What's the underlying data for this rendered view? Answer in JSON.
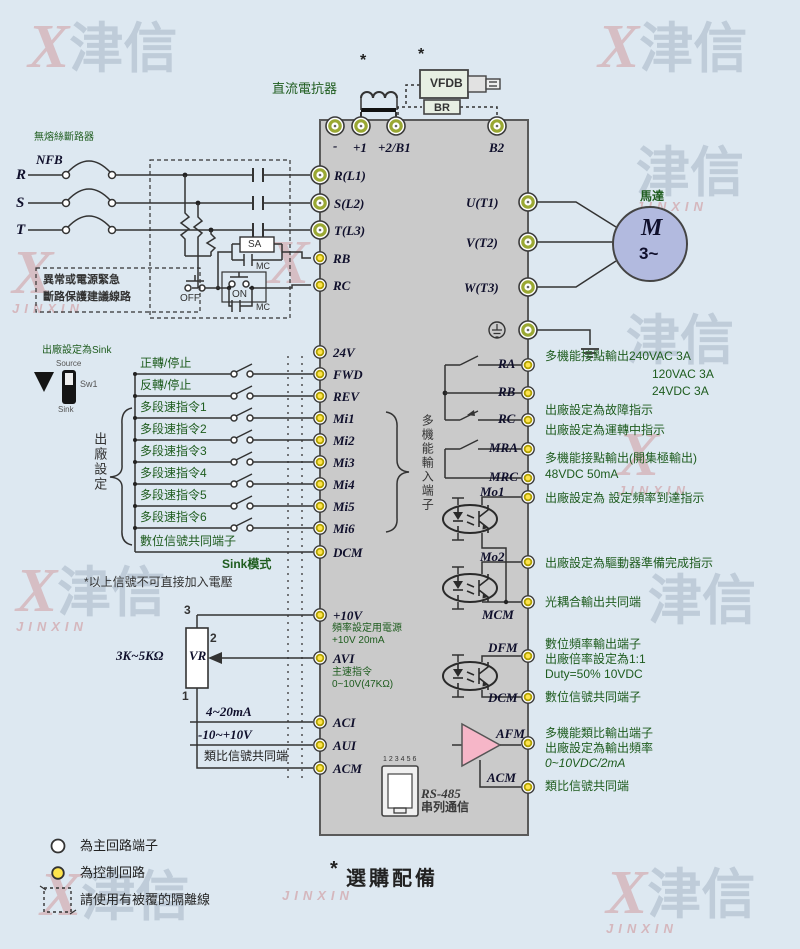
{
  "watermark": {
    "x": "X",
    "cn": "津信",
    "en": "JINXIN"
  },
  "colors": {
    "background": "#dde8f1",
    "block": "#cacaca",
    "annotation_green": "#1e5c1e",
    "terminal_navy": "#10102c",
    "main_terminal_ring": "#9aa833",
    "control_terminal_fill": "#ffe44d",
    "motor_fill": "#b2badf",
    "afm_triangle": "#f6b6c8",
    "vfdb_fill": "#e7efe3"
  },
  "top": {
    "optional_star1": "*",
    "optional_star2": "*",
    "dc_reactor_label": "直流電抗器",
    "vfdb_label": "VFDB",
    "br_label": "BR",
    "terminal_minus": "-",
    "terminal_p1": "+1",
    "terminal_p2b1": "+2/B1",
    "terminal_b2": "B2"
  },
  "power_input": {
    "breaker_note": "無熔絲斷路器",
    "nfb_label": "NFB",
    "phase_r": "R",
    "phase_s": "S",
    "phase_t": "T",
    "r_l1": "R(L1)",
    "s_l2": "S(L2)",
    "t_l3": "T(L3)",
    "protect_note_line1": "異常或電源緊急",
    "protect_note_line2": "斷路保護建議線路",
    "sa_label": "SA",
    "mc_label1": "MC",
    "off_label": "OFF",
    "on_label": "ON",
    "mc_label2": "MC",
    "rb": "RB",
    "rc": "RC"
  },
  "digital_inputs": {
    "sink_default_note": "出廠設定為Sink",
    "source_label": "Source",
    "sw1_label": "Sw1",
    "sink_label": "Sink",
    "factory_brace_label": "出廠設定",
    "terminal_24v": "24V",
    "rows": [
      {
        "label": "正轉/停止",
        "terminal": "FWD"
      },
      {
        "label": "反轉/停止",
        "terminal": "REV"
      },
      {
        "label": "多段速指令1",
        "terminal": "Mi1"
      },
      {
        "label": "多段速指令2",
        "terminal": "Mi2"
      },
      {
        "label": "多段速指令3",
        "terminal": "Mi3"
      },
      {
        "label": "多段速指令4",
        "terminal": "Mi4"
      },
      {
        "label": "多段速指令5",
        "terminal": "Mi5"
      },
      {
        "label": "多段速指令6",
        "terminal": "Mi6"
      },
      {
        "label": "數位信號共同端子",
        "terminal": "DCM"
      }
    ],
    "multi_input_brace_label": "多機能輸入端子",
    "sink_mode": "Sink模式",
    "voltage_warning": "*以上信號不可直接加入電壓"
  },
  "analog_inputs": {
    "vr_value": "3K~5KΩ",
    "vr_label": "VR",
    "pin3": "3",
    "pin2": "2",
    "pin1": "1",
    "p10v": "+10V",
    "p10v_note1": "頻率設定用電源",
    "p10v_note2": "+10V 20mA",
    "avi": "AVI",
    "avi_note1": "主速指令",
    "avi_note2": "0~10V(47KΩ)",
    "aci": "ACI",
    "aci_signal": "4~20mA",
    "aui": "AUI",
    "aui_signal": "-10~+10V",
    "acm": "ACM",
    "acm_signal": "類比信號共同端"
  },
  "motor_output": {
    "u_t1": "U(T1)",
    "v_t2": "V(T2)",
    "w_t3": "W(T3)",
    "motor_label": "馬達",
    "motor_m": "M",
    "motor_phase": "3~"
  },
  "relay_outputs": {
    "ra": "RA",
    "rb": "RB",
    "rc": "RC",
    "mra": "MRA",
    "mrc": "MRC",
    "note1": "多機能接點輸出240VAC 3A",
    "note2": "120VAC 3A",
    "note3": "24VDC 3A",
    "note4": "出廠設定為故障指示",
    "note5": "出廠設定為運轉中指示",
    "note6": "多機能接點輸出(開集極輸出)",
    "note7": "48VDC 50mA"
  },
  "opto_outputs": {
    "mo1": "Mo1",
    "mo1_note": "出廠設定為 設定頻率到達指示",
    "mo2": "Mo2",
    "mo2_note": "出廠設定為驅動器準備完成指示",
    "mcm": "MCM",
    "mcm_note": "光耦合輸出共同端"
  },
  "dfm_output": {
    "dfm": "DFM",
    "note1": "數位頻率輸出端子",
    "note2": "出廠倍率設定為1:1",
    "note3": "Duty=50% 10VDC",
    "dcm": "DCM",
    "dcm_note": "數位信號共同端子"
  },
  "afm_output": {
    "afm": "AFM",
    "note1": "多機能類比輸出端子",
    "note2": "出廠設定為輸出頻率",
    "note3": "0~10VDC/2mA",
    "acm": "ACM",
    "acm_note": "類比信號共同端"
  },
  "rs485": {
    "pins": "123456",
    "label": "RS-485",
    "label2": "串列通信"
  },
  "legend": {
    "main_circuit": "為主回路端子",
    "control_circuit": "為控制回路",
    "shielded": "請使用有被覆的隔離線",
    "optional_star": "*",
    "optional": "選購配備"
  }
}
